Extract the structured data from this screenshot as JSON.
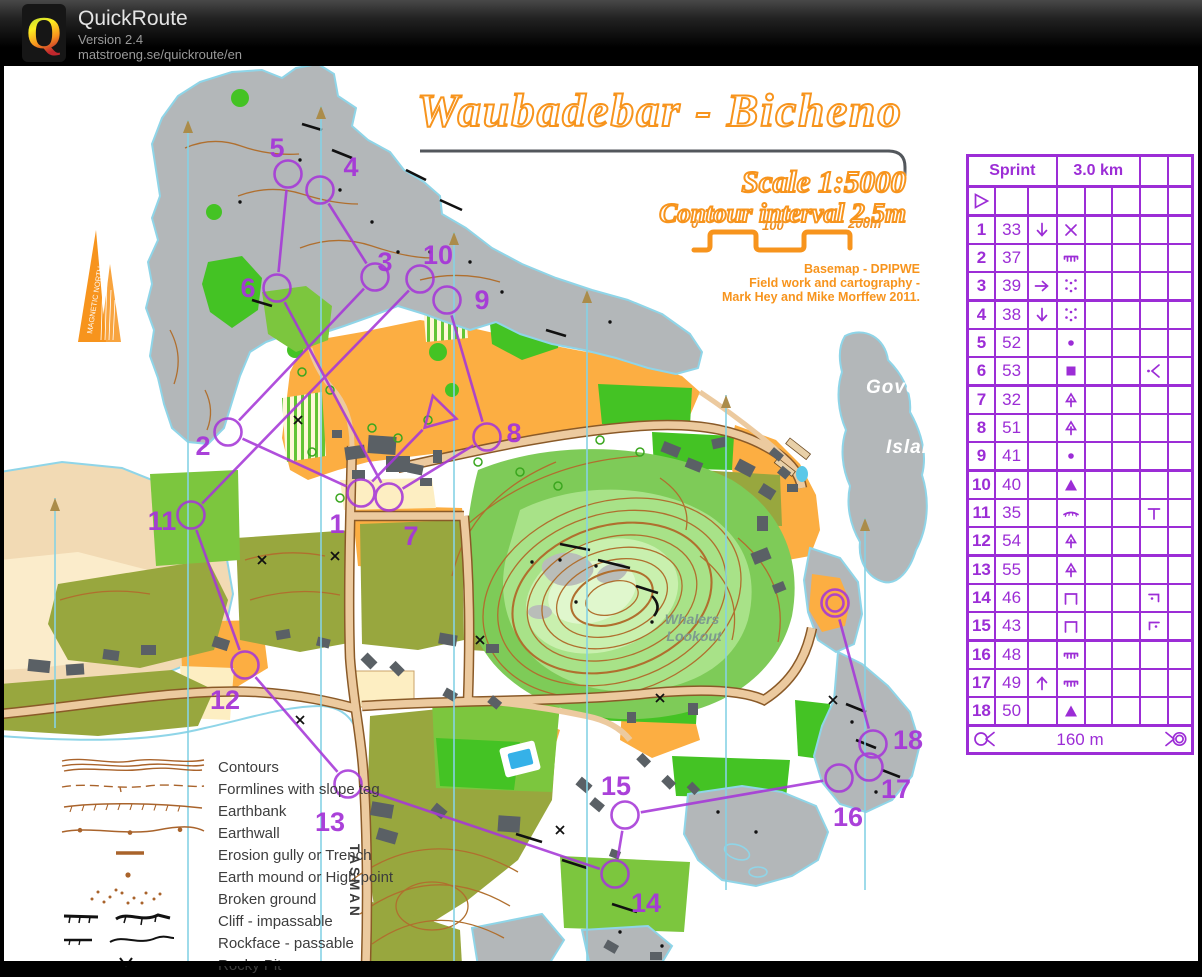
{
  "header": {
    "app_name": "QuickRoute",
    "version": "Version 2.4",
    "website": "matstroeng.se/quickroute/en"
  },
  "map": {
    "title": "Waubadebar - Bicheno",
    "scale_text": "Scale 1:5000",
    "contour_text": "Contour interval 2.5m",
    "credit_line1": "Basemap - DPIPWE",
    "credit_line2": "Field work and cartography -",
    "credit_line3": "Mark Hey and Mike Morffew 2011.",
    "scale_bar": {
      "tick0": "0",
      "tick1": "100",
      "tick2": "200m"
    },
    "north_arrow_label": "MAGNETIC NORTH",
    "place_labels": {
      "governor": "Governor",
      "island": "Island",
      "whalers": "Whalers",
      "lookout": "Lookout",
      "street": "TASMAN"
    }
  },
  "legend": {
    "items": [
      {
        "symbol": "contours",
        "label": "Contours"
      },
      {
        "symbol": "formlines",
        "label": "Formlines with slope tag"
      },
      {
        "symbol": "earthbank",
        "label": "Earthbank"
      },
      {
        "symbol": "earthwall",
        "label": "Earthwall"
      },
      {
        "symbol": "erosion-gully",
        "label": "Erosion gully or Trench"
      },
      {
        "symbol": "earth-mound",
        "label": "Earth mound or High point"
      },
      {
        "symbol": "broken-ground",
        "label": "Broken ground"
      },
      {
        "symbol": "cliff-impassable",
        "label": "Cliff - impassable"
      },
      {
        "symbol": "rockface-passable",
        "label": "Rockface - passable"
      },
      {
        "symbol": "rocky-pit",
        "label": "Rocky Pit"
      }
    ]
  },
  "course": {
    "color": "#a637d8",
    "start": {
      "x": 438,
      "y": 414
    },
    "finish": {
      "x": 835,
      "y": 603
    },
    "controls": [
      {
        "n": 1,
        "x": 361,
        "y": 493,
        "lx": 337,
        "ly": 524
      },
      {
        "n": 2,
        "x": 228,
        "y": 432,
        "lx": 203,
        "ly": 446
      },
      {
        "n": 3,
        "x": 375,
        "y": 277,
        "lx": 385,
        "ly": 262
      },
      {
        "n": 4,
        "x": 320,
        "y": 190,
        "lx": 351,
        "ly": 167
      },
      {
        "n": 5,
        "x": 288,
        "y": 174,
        "lx": 277,
        "ly": 148
      },
      {
        "n": 6,
        "x": 277,
        "y": 288,
        "lx": 248,
        "ly": 288
      },
      {
        "n": 7,
        "x": 389,
        "y": 497,
        "lx": 411,
        "ly": 536
      },
      {
        "n": 8,
        "x": 487,
        "y": 437,
        "lx": 514,
        "ly": 433
      },
      {
        "n": 9,
        "x": 447,
        "y": 300,
        "lx": 482,
        "ly": 300
      },
      {
        "n": 10,
        "x": 420,
        "y": 279,
        "lx": 438,
        "ly": 255
      },
      {
        "n": 11,
        "x": 191,
        "y": 515,
        "lx": 162,
        "ly": 521
      },
      {
        "n": 12,
        "x": 245,
        "y": 665,
        "lx": 225,
        "ly": 700
      },
      {
        "n": 13,
        "x": 348,
        "y": 784,
        "lx": 330,
        "ly": 822
      },
      {
        "n": 14,
        "x": 615,
        "y": 874,
        "lx": 646,
        "ly": 903
      },
      {
        "n": 15,
        "x": 625,
        "y": 815,
        "lx": 616,
        "ly": 786
      },
      {
        "n": 16,
        "x": 839,
        "y": 778,
        "lx": 848,
        "ly": 817
      },
      {
        "n": 17,
        "x": 869,
        "y": 767,
        "lx": 896,
        "ly": 789
      },
      {
        "n": 18,
        "x": 873,
        "y": 744,
        "lx": 908,
        "ly": 740
      }
    ]
  },
  "control_card": {
    "color": "#9c2dd6",
    "title_left": "Sprint",
    "title_right": "3.0 km",
    "finish_distance": "160 m",
    "rows": [
      {
        "n": "1",
        "code": "33",
        "c": "arrow-down",
        "d": "cross"
      },
      {
        "n": "2",
        "code": "37",
        "c": "",
        "d": "earthbank"
      },
      {
        "n": "3",
        "code": "39",
        "c": "arrow-right",
        "d": "broken-ground"
      },
      {
        "n": "4",
        "code": "38",
        "c": "arrow-down",
        "d": "broken-ground"
      },
      {
        "n": "5",
        "code": "52",
        "c": "",
        "d": "dot"
      },
      {
        "n": "6",
        "code": "53",
        "c": "",
        "d": "square",
        "g": "angle-dot"
      },
      {
        "n": "7",
        "code": "32",
        "c": "",
        "d": "tree"
      },
      {
        "n": "8",
        "code": "51",
        "c": "",
        "d": "tree"
      },
      {
        "n": "9",
        "code": "41",
        "c": "",
        "d": "dot"
      },
      {
        "n": "10",
        "code": "40",
        "c": "",
        "d": "triangle"
      },
      {
        "n": "11",
        "code": "35",
        "c": "",
        "d": "earthbank-curved",
        "g": "tee"
      },
      {
        "n": "12",
        "code": "54",
        "c": "",
        "d": "tree"
      },
      {
        "n": "13",
        "code": "55",
        "c": "",
        "d": "tree"
      },
      {
        "n": "14",
        "code": "46",
        "c": "",
        "d": "wall",
        "g": "corner-right"
      },
      {
        "n": "15",
        "code": "43",
        "c": "",
        "d": "wall",
        "g": "corner-left"
      },
      {
        "n": "16",
        "code": "48",
        "c": "",
        "d": "earthbank"
      },
      {
        "n": "17",
        "code": "49",
        "c": "arrow-up",
        "d": "earthbank"
      },
      {
        "n": "18",
        "code": "50",
        "c": "",
        "d": "triangle"
      }
    ]
  }
}
